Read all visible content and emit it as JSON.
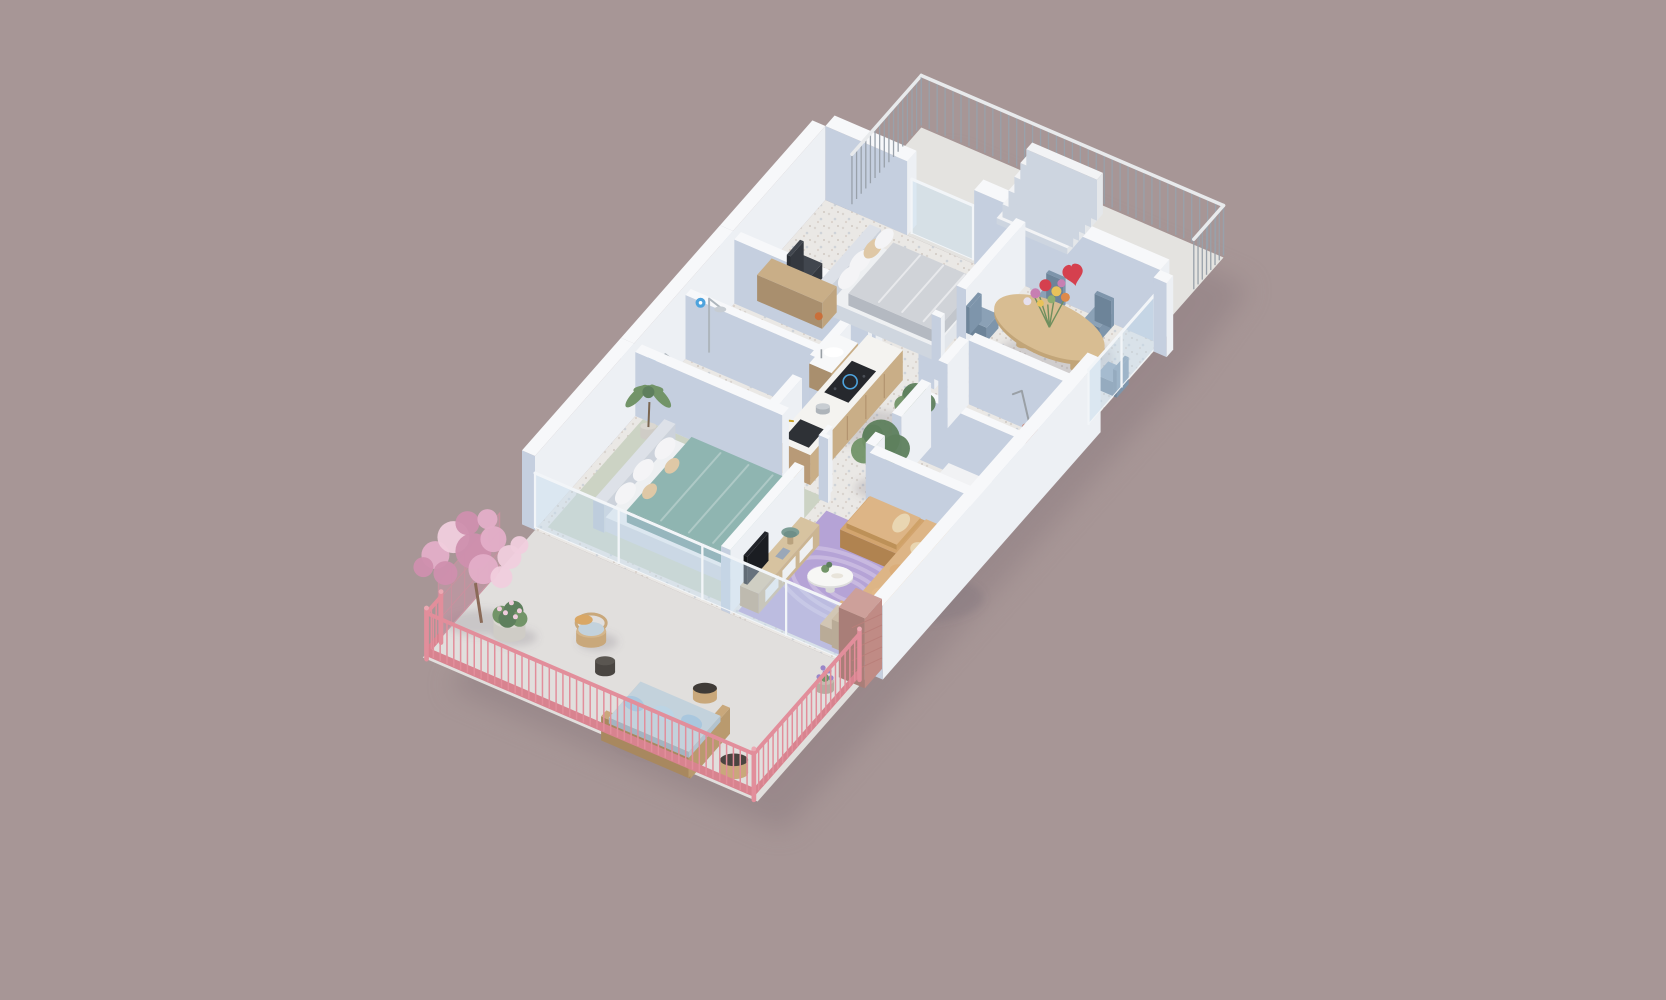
{
  "meta": {
    "type": "3d-isometric-floor-plan-render",
    "description": "furnished apartment 3D floor plan on mauve background"
  },
  "palette": {
    "background": "#a79696",
    "buildingShadow": "#8c7b80",
    "floorTerrazzo": "#eae8e5",
    "terrazzoDotA": "#d9d4cf",
    "terrazzoDotB": "#cfd3d8",
    "floorTerrace": "#e4e3e0",
    "floorBalcony": "#e1dfdd",
    "floorSage": "#ccd3c4",
    "wallTop": "#f7f8fa",
    "wallLight": "#edf0f4",
    "wallShade": "#c5cfdf",
    "glass": "rgba(198,219,238,0.45)",
    "frame": "#f2f5f8",
    "railGray": "#99a1aa",
    "railGrayTop": "#e8eaec",
    "railPink": "#e28e9b",
    "railPinkBand": "#d8838f",
    "brick": "#c08b85",
    "brickLight": "#cda09a",
    "brickDark": "#a97e78",
    "wood": "#c9ae87",
    "woodDark": "#b89a77",
    "woodLight": "#d7c3a0",
    "counterTop": "#f4f3f0",
    "cooktop": "#26282d",
    "sinkDark": "#2e3136",
    "brass": "#c9a227",
    "bedBase": "#eef0f2",
    "headboard": "#dde1e8",
    "duvetGray": "#d0d3d8",
    "duvetTeal": "#8fb5b1",
    "pillowWhite": "#f4f4f6",
    "pillowTan": "#dfc8a6",
    "sofaCamel": "#d2a46e",
    "sofaCamelLight": "#ddb586",
    "cushionSand": "#e9d6b2",
    "rug": "#b5a3d6",
    "rugLine": "#c8b9e0",
    "tableWood": "#d8bd92",
    "tableWoodSide": "#c2a578",
    "chairBlue": "#7e95ab",
    "chairBlueTop": "#8ba1b6",
    "chairBlueDark": "#6d8499",
    "plantGreen": "#5e7f5d",
    "plantGreenLight": "#729468",
    "trunk": "#7a6652",
    "potGray": "#cfccc6",
    "potTop": "#dad7d1",
    "blossom": "#e3aec8",
    "blossomLight": "#f0cddd",
    "blossomDeep": "#cf8fae",
    "wicker": "#c9a87b",
    "wickerDark": "#a8885f",
    "cushionBlue": "#c3d2dc",
    "pillowBlue": "#a9c7de",
    "darkTable": "#4a4642",
    "lamp": "#7c9d95",
    "tv": "#1b1d22",
    "applianceWhite": "#f1f2f4",
    "vacuum": "#b5776b",
    "blueAccent": "#4da3dd",
    "flowerRed": "#d5404e",
    "flowerPink": "#c77fb2",
    "flowerYellow": "#e8c25a",
    "flowerOrange": "#dd8a4a",
    "shadow": "rgba(104,94,110,0.20)"
  },
  "scene": {
    "label": "apartment-3d-floor-plan",
    "rooms": [
      {
        "name": "terrace",
        "items": [
          "metal-railing",
          "staircase"
        ]
      },
      {
        "name": "bedroom-1",
        "items": [
          "double-bed-gray",
          "desk",
          "desk-chair"
        ]
      },
      {
        "name": "dining-room",
        "items": [
          "oval-dining-table",
          "dining-chairs-x6",
          "flower-bouquet",
          "heart-decoration"
        ]
      },
      {
        "name": "kitchen",
        "items": [
          "cabinet-counter",
          "induction-cooktop",
          "black-sink",
          "pot"
        ]
      },
      {
        "name": "bathroom-1",
        "items": [
          "walk-in-shower",
          "toilet"
        ]
      },
      {
        "name": "bathroom-2",
        "items": [
          "walk-in-shower",
          "vanity-sink"
        ]
      },
      {
        "name": "hallway",
        "items": [
          "potted-tree",
          "potted-tree-small"
        ]
      },
      {
        "name": "storage-room-1",
        "items": [
          "washer-dryer"
        ]
      },
      {
        "name": "storage-room-2",
        "items": [
          "vacuum-cleaner"
        ]
      },
      {
        "name": "bedroom-2",
        "items": [
          "double-bed-teal",
          "potted-palm",
          "sage-carpet"
        ]
      },
      {
        "name": "living-room",
        "items": [
          "corner-sofa",
          "wavy-purple-rug",
          "round-coffee-table",
          "ottoman",
          "tv-sideboard",
          "tv",
          "mushroom-lamp"
        ]
      },
      {
        "name": "balcony",
        "items": [
          "pink-railing",
          "cherry-blossom-tree",
          "trellis",
          "flower-planter",
          "wicker-chair",
          "wicker-sofa",
          "rattan-side-tables",
          "lavender-pot",
          "brick-pillar"
        ]
      }
    ]
  }
}
